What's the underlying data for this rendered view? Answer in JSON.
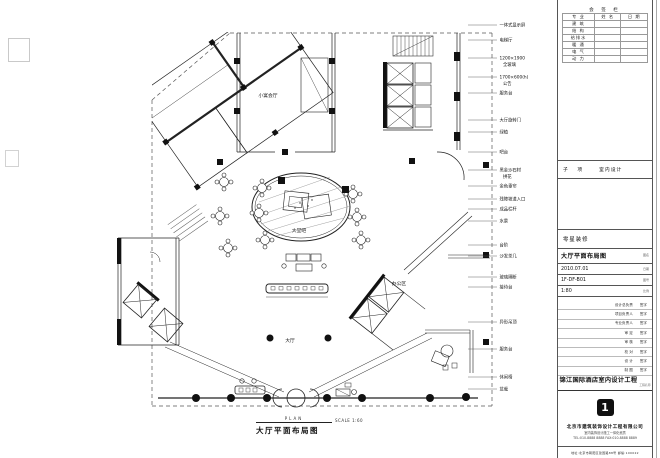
{
  "footer": {
    "plan_en": "PLAN",
    "scale_note": "SCALE 1:60",
    "title_cn": "大厅平面布局图"
  },
  "plan": {
    "room_labels": [
      {
        "x": 268,
        "y": 97,
        "text": "小宴会厅"
      },
      {
        "x": 299,
        "y": 232,
        "text": "大堂吧"
      },
      {
        "x": 290,
        "y": 342,
        "text": "大厅"
      },
      {
        "x": 399,
        "y": 285,
        "text": "办公区"
      }
    ],
    "callouts": [
      {
        "y": 25,
        "lines": [
          "一体式显示屏"
        ]
      },
      {
        "y": 40,
        "lines": [
          "电梯厅"
        ]
      },
      {
        "y": 58,
        "lines": [
          "1200×1900",
          "全玻璃"
        ]
      },
      {
        "y": 77,
        "lines": [
          "1700×600(h)",
          "公告"
        ]
      },
      {
        "y": 93,
        "lines": [
          "服务台"
        ]
      },
      {
        "y": 120,
        "lines": [
          "大厅旋转门"
        ]
      },
      {
        "y": 132,
        "lines": [
          "绿植"
        ]
      },
      {
        "y": 152,
        "lines": [
          "吧台"
        ]
      },
      {
        "y": 170,
        "lines": [
          "黑金沙石材",
          "拼花"
        ]
      },
      {
        "y": 186,
        "lines": [
          "金色垂帘"
        ]
      },
      {
        "y": 199,
        "lines": [
          "残障坡道入口"
        ]
      },
      {
        "y": 209,
        "lines": [
          "成品栏杆"
        ]
      },
      {
        "y": 221,
        "lines": [
          "水景"
        ]
      },
      {
        "y": 245,
        "lines": [
          "台阶"
        ]
      },
      {
        "y": 256,
        "lines": [
          "沙发茶几"
        ]
      },
      {
        "y": 277,
        "lines": [
          "玻璃隔断"
        ]
      },
      {
        "y": 287,
        "lines": [
          "接待台"
        ]
      },
      {
        "y": 322,
        "lines": [
          "异形吊顶"
        ]
      },
      {
        "y": 349,
        "lines": [
          "服务台"
        ]
      },
      {
        "y": 377,
        "lines": [
          "休闲椅"
        ]
      },
      {
        "y": 389,
        "lines": [
          "盆栽"
        ]
      }
    ]
  },
  "titleblock": {
    "sign_table": {
      "title": "会 签 栏",
      "headers": [
        "专 业",
        "姓 名",
        "日 期"
      ],
      "rows": [
        "建 筑",
        "结 构",
        "给排水",
        "暖 通",
        "电 气",
        "动 力"
      ]
    },
    "subproject_label": "子 项",
    "subproject_value": "室内设计",
    "misc_row": "零星装修",
    "info_rows": [
      {
        "value": "大厅平面布局图",
        "tag": "图名"
      },
      {
        "value": "2010.07.01",
        "tag": "日期"
      },
      {
        "value": "1F-DF-B01",
        "tag": "图号"
      },
      {
        "value": "1:80",
        "tag": "比例"
      }
    ],
    "credit_rows": [
      [
        "设计总负责",
        "签字"
      ],
      [
        "项目负责人",
        "签字"
      ],
      [
        "专业负责人",
        "签字"
      ],
      [
        "审  定",
        "签字"
      ],
      [
        "审  核",
        "签字"
      ],
      [
        "校  对",
        "签字"
      ],
      [
        "设  计",
        "签字"
      ],
      [
        "制  图",
        "签字"
      ]
    ],
    "project_name": "锦江国际酒店室内设计工程",
    "project_tag": "工程名称",
    "logo_glyph": "1",
    "company_line1": "北京市建筑装饰设计工程有限公司",
    "company_line2": "室内装饰设计施工一体化资质",
    "company_line3": "TEL:010-8888 8888  FAX:010-8888 8889",
    "address_line": "地址:北京市朝阳区建国路88号  邮编:100022"
  }
}
